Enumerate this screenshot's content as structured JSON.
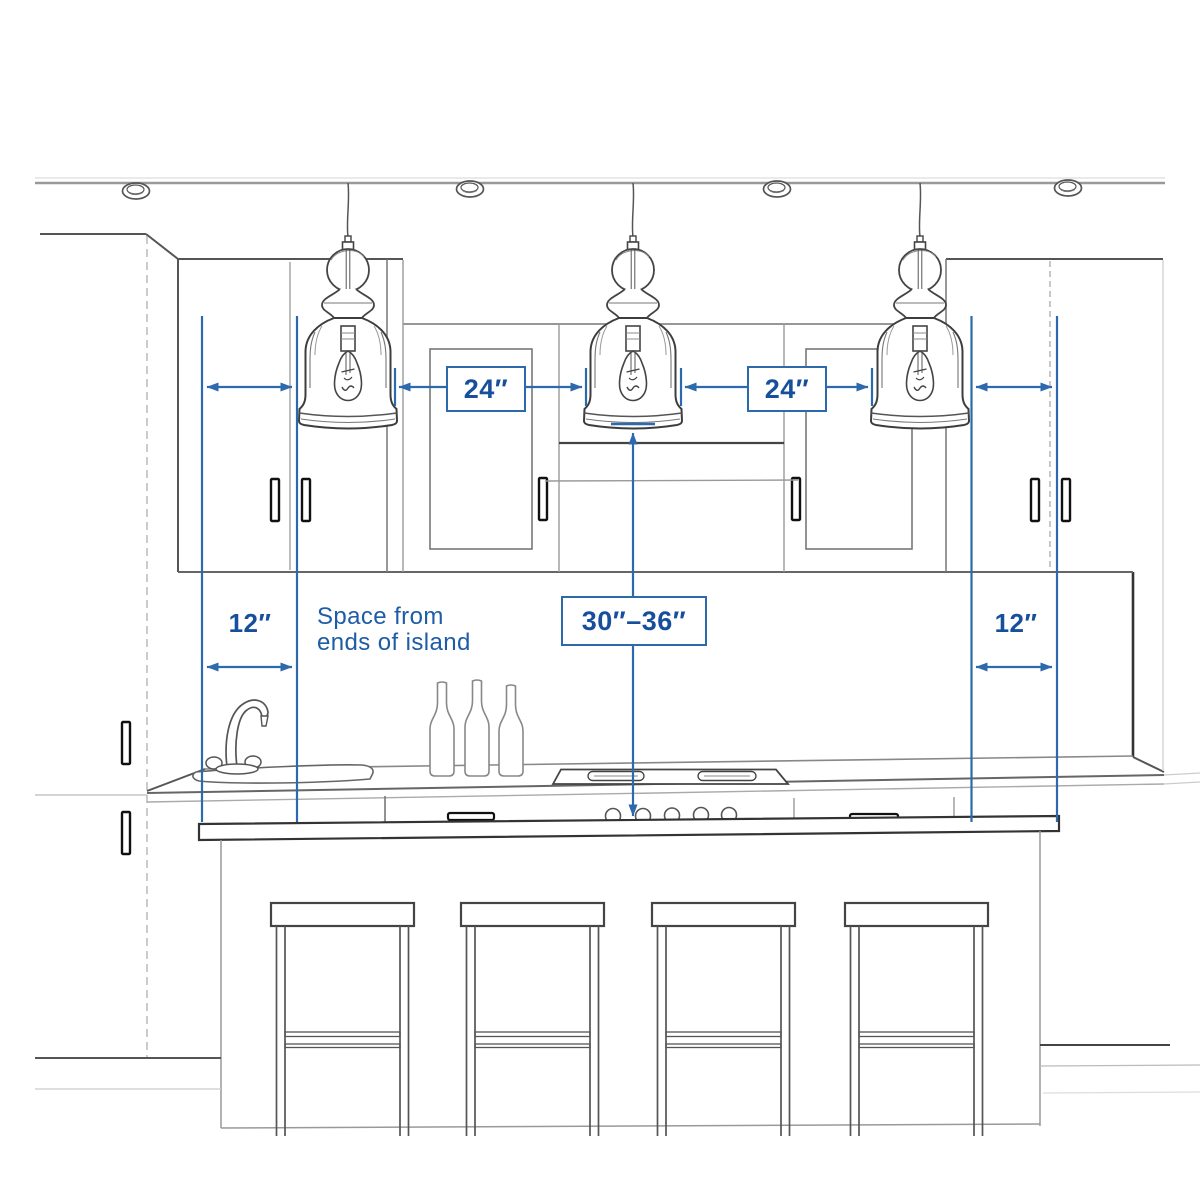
{
  "diagram": {
    "annotations": {
      "pendant_gap_left": "24″",
      "pendant_gap_right": "24″",
      "island_end_left": "12″",
      "island_end_right": "12″",
      "hang_height": "30″–36″",
      "note_line1": "Space from",
      "note_line2": "ends of island"
    },
    "colors": {
      "annotation_line": "#2d6aad",
      "annotation_text": "#174f9c",
      "sketch_dark": "#3f3f3f",
      "sketch_mid": "#777777",
      "sketch_light": "#aaaaaa"
    },
    "counts": {
      "pendant_lights": 3,
      "bar_stools": 4,
      "recessed_ceiling_lights": 4,
      "bottles": 3,
      "cooktop_knobs": 5
    }
  }
}
